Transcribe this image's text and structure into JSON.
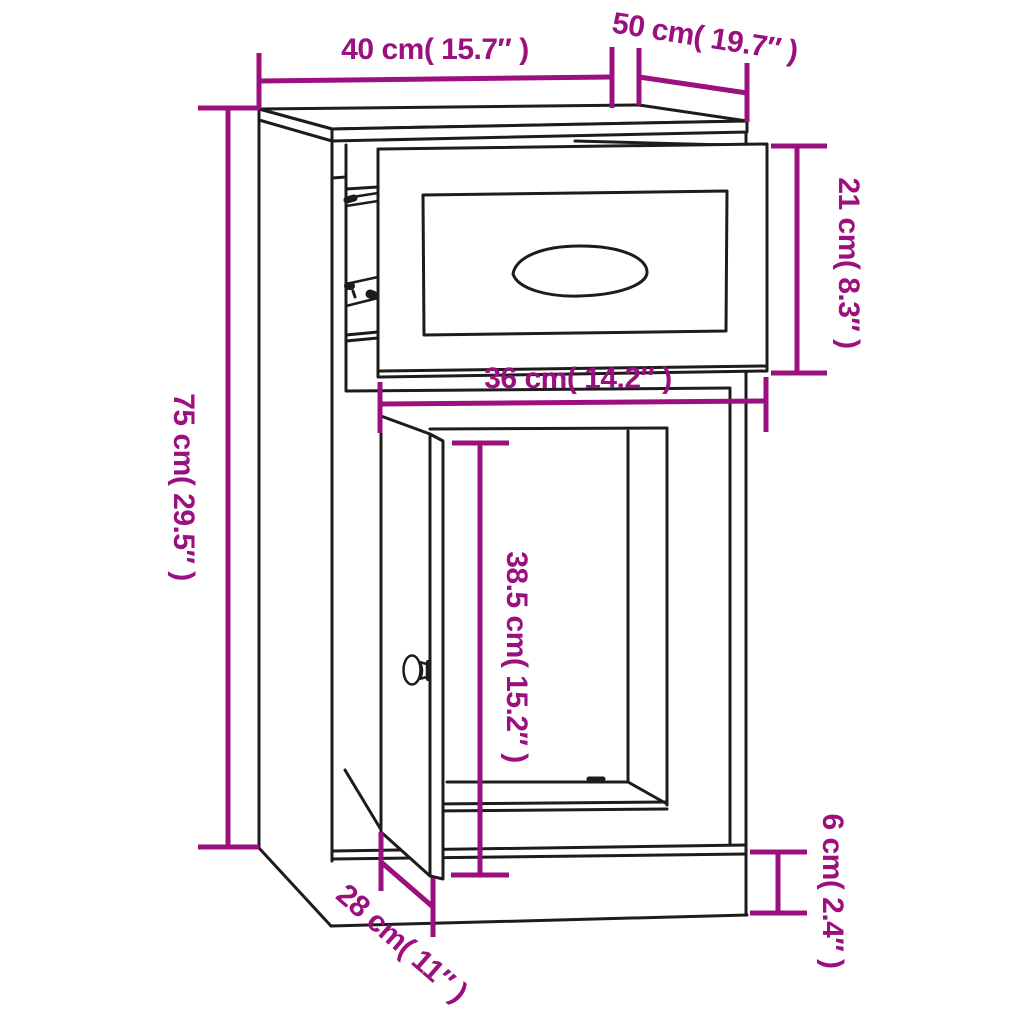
{
  "diagram": {
    "kind": "furniture-dimension-diagram",
    "subject": "side cabinet with pulled-out drawer and open door",
    "colors": {
      "accent": "#9B107E",
      "line": "#1C1C1C",
      "background": "#FFFFFF"
    },
    "dimensions": {
      "overall_width": {
        "label": "40 cm( 15.7″ )",
        "cm": 40,
        "inches": 15.7
      },
      "overall_depth": {
        "label": "50 cm( 19.7″ )",
        "cm": 50,
        "inches": 19.7
      },
      "drawer_height": {
        "label": "21 cm( 8.3″ )",
        "cm": 21,
        "inches": 8.3
      },
      "overall_height": {
        "label": "75 cm( 29.5″ )",
        "cm": 75,
        "inches": 29.5
      },
      "inner_width": {
        "label": "36 cm( 14.2″ )",
        "cm": 36,
        "inches": 14.2
      },
      "door_height": {
        "label": "38.5 cm( 15.2″ )",
        "cm": 38.5,
        "inches": 15.2
      },
      "base_depth": {
        "label": "28 cm( 11″ )",
        "cm": 28,
        "inches": 11
      },
      "base_height": {
        "label": "6 cm( 2.4″ )",
        "cm": 6,
        "inches": 2.4
      }
    }
  }
}
